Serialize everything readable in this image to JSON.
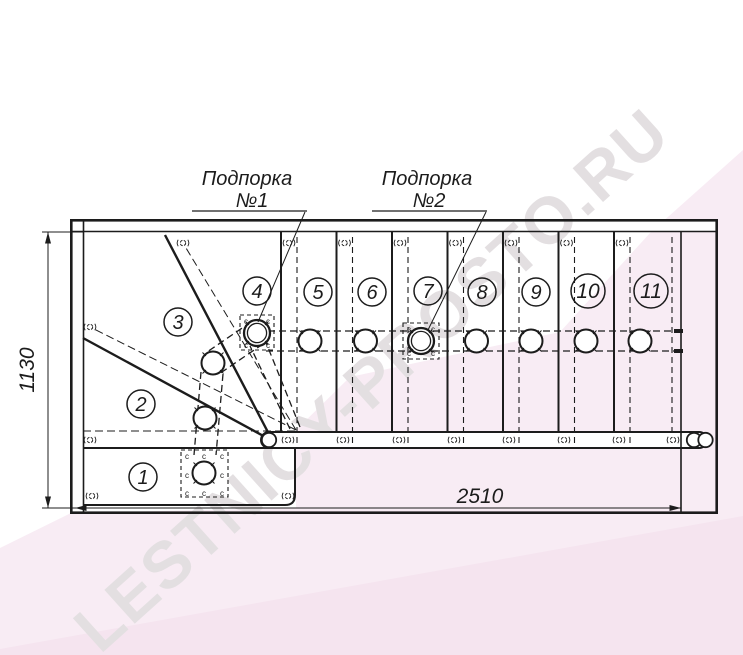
{
  "labels": {
    "support1": {
      "line1": "Подпорка",
      "line2": "№1"
    },
    "support2": {
      "line1": "Подпорка",
      "line2": "№2"
    }
  },
  "dimensions": {
    "width": "2510",
    "height": "1130"
  },
  "step_numbers": [
    "1",
    "2",
    "3",
    "4",
    "5",
    "6",
    "7",
    "8",
    "9",
    "10",
    "11"
  ],
  "plate_mark": "c",
  "watermark": {
    "text": "LESTNICY-PROSTO.RU"
  },
  "colors": {
    "line": "#1c1c1c",
    "pink_light": "#f8ecf4",
    "pink_deep": "#f5e4ef",
    "watermark": "#e3dfe1",
    "paper": "#ffffff"
  }
}
